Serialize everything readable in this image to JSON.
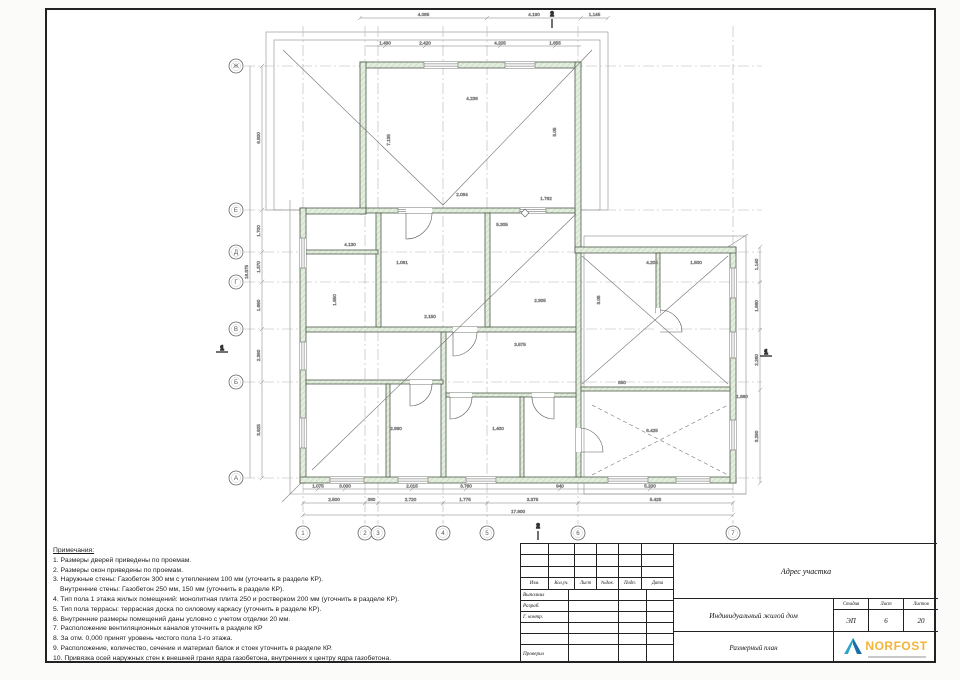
{
  "sheet": {
    "frame_color": "#222222"
  },
  "plan": {
    "colors": {
      "wall_fill": "#e3edde",
      "wall_stroke": "#4f5a4c",
      "axis": "#b3b3b3",
      "thin": "#8a8a8a",
      "diag": "#6a6a6a",
      "dim_line": "#7d7d7d",
      "dim_text": "#555555",
      "circle": "#666666"
    },
    "axes_h": [
      {
        "label": "Ж",
        "y": 66
      },
      {
        "label": "Е",
        "y": 210
      },
      {
        "label": "Д",
        "y": 252
      },
      {
        "label": "Г",
        "y": 282
      },
      {
        "label": "В",
        "y": 329
      },
      {
        "label": "Б",
        "y": 382
      },
      {
        "label": "А",
        "y": 478
      }
    ],
    "axes_v": [
      {
        "label": "1",
        "x": 303
      },
      {
        "label": "2",
        "x": 365
      },
      {
        "label": "3",
        "x": 378
      },
      {
        "label": "4",
        "x": 443
      },
      {
        "label": "5",
        "x": 487
      },
      {
        "label": "6",
        "x": 578
      },
      {
        "label": "7",
        "x": 733
      }
    ],
    "walls": [
      [
        360,
        62,
        221,
        6
      ],
      [
        360,
        62,
        6,
        152
      ],
      [
        575,
        62,
        6,
        191
      ],
      [
        300,
        208,
        66,
        6
      ],
      [
        300,
        208,
        6,
        275
      ],
      [
        300,
        477,
        436,
        6
      ],
      [
        730,
        247,
        6,
        236
      ],
      [
        575,
        247,
        161,
        6
      ],
      [
        366,
        208,
        209,
        5
      ],
      [
        306,
        327,
        272,
        5
      ],
      [
        376,
        213,
        5,
        114
      ],
      [
        441,
        332,
        5,
        145
      ],
      [
        485,
        213,
        5,
        114
      ],
      [
        576,
        253,
        5,
        224
      ],
      [
        306,
        380,
        137,
        4
      ],
      [
        446,
        393,
        130,
        4
      ],
      [
        581,
        387,
        149,
        4
      ],
      [
        656,
        253,
        4,
        60
      ],
      [
        520,
        397,
        4,
        80
      ],
      [
        386,
        384,
        4,
        93
      ],
      [
        306,
        250,
        72,
        4
      ]
    ],
    "overhangs": [
      [
        266,
        32,
        342,
        178
      ],
      [
        274,
        40,
        326,
        170
      ],
      [
        584,
        236,
        162,
        258
      ]
    ],
    "outline_lines": [
      [
        290,
        200,
        290,
        494
      ],
      [
        290,
        494,
        746,
        494
      ],
      [
        282,
        502,
        302,
        482
      ],
      [
        723,
        250,
        748,
        234
      ]
    ],
    "windows": [
      [
        424,
        62,
        34,
        6,
        "h"
      ],
      [
        505,
        62,
        30,
        6,
        "h"
      ],
      [
        300,
        238,
        6,
        30,
        "v"
      ],
      [
        300,
        342,
        6,
        28,
        "v"
      ],
      [
        300,
        418,
        6,
        30,
        "v"
      ],
      [
        330,
        477,
        34,
        6,
        "h"
      ],
      [
        398,
        477,
        30,
        6,
        "h"
      ],
      [
        466,
        477,
        30,
        6,
        "h"
      ],
      [
        608,
        477,
        40,
        6,
        "h"
      ],
      [
        676,
        477,
        34,
        6,
        "h"
      ],
      [
        730,
        268,
        6,
        30,
        "v"
      ],
      [
        730,
        332,
        6,
        26,
        "v"
      ],
      [
        730,
        420,
        6,
        30,
        "v"
      ],
      [
        398,
        208,
        26,
        5,
        "h"
      ],
      [
        520,
        208,
        26,
        5,
        "h"
      ]
    ],
    "doors": [
      {
        "gap": [
          406,
          208,
          26,
          5
        ],
        "path": "M406,213 V239 A26,26 0 0 0 432,213"
      },
      {
        "gap": [
          453,
          327,
          24,
          5
        ],
        "path": "M453,332 V356 A24,24 0 0 0 477,332"
      },
      {
        "gap": [
          656,
          308,
          4,
          24
        ],
        "path": "M660,332 H682 A22,22 0 0 0 660,310"
      },
      {
        "gap": [
          450,
          393,
          22,
          4
        ],
        "path": "M450,397 V419 A22,22 0 0 0 472,397"
      },
      {
        "gap": [
          532,
          393,
          22,
          4
        ],
        "path": "M554,397 V419 A22,22 0 0 1 532,397"
      },
      {
        "gap": [
          410,
          380,
          22,
          4
        ],
        "path": "M410,384 V406 A22,22 0 0 0 432,384"
      },
      {
        "gap": [
          576,
          428,
          5,
          24
        ],
        "path": "M581,452 H603 A24,24 0 0 0 581,428"
      }
    ],
    "diagonals": [
      {
        "l": [
          283,
          50,
          443,
          205
        ]
      },
      {
        "l": [
          592,
          50,
          443,
          205
        ]
      },
      {
        "l": [
          312,
          470,
          576,
          214
        ]
      },
      {
        "l": [
          582,
          256,
          728,
          384
        ]
      },
      {
        "l": [
          582,
          384,
          728,
          256
        ]
      },
      {
        "l": [
          592,
          405,
          728,
          475
        ],
        "dash": true
      },
      {
        "l": [
          592,
          475,
          728,
          405
        ],
        "dash": true
      }
    ],
    "dims": {
      "bottom": {
        "y": 503,
        "ticks": [
          303,
          365,
          378,
          443,
          487,
          578,
          733
        ],
        "labels": [
          "2.500",
          "380",
          "2.720",
          "1.775",
          "3.375",
          "5.425"
        ]
      },
      "bottom_total": {
        "y": 515,
        "x1": 303,
        "x2": 733,
        "label": "17.900"
      },
      "bottom2": {
        "y": 489,
        "x1": 303,
        "x2": 733,
        "labels": [
          [
            "1.075",
            318
          ],
          [
            "3.000",
            345
          ],
          [
            "2.015",
            412
          ],
          [
            "3.760",
            466
          ],
          [
            "940",
            560
          ],
          [
            "5.200",
            650
          ]
        ]
      },
      "left": {
        "x": 262,
        "ticks": [
          66,
          210,
          252,
          282,
          329,
          382,
          478
        ],
        "labels": [
          "6.800",
          "1.700",
          "1.370",
          "1.690",
          "2.360",
          "3.925"
        ]
      },
      "left_total": {
        "x": 250,
        "y1": 66,
        "y2": 478,
        "label": "16.875"
      },
      "top": {
        "y": 18,
        "ticks": [
          360,
          487,
          581,
          608
        ],
        "labels": [
          "4.085",
          "4.190",
          "1.145"
        ]
      },
      "top2": {
        "y": 46,
        "x1": 366,
        "x2": 581,
        "labels": [
          [
            "1.480",
            385
          ],
          [
            "2.420",
            425
          ],
          [
            "4.205",
            500
          ],
          [
            "1.855",
            555
          ]
        ]
      },
      "right": {
        "x": 760,
        "ticks": [
          247,
          282,
          330,
          390,
          483
        ],
        "labels": [
          "1.140",
          "1.860",
          "2.260",
          "3.290"
        ]
      },
      "misc": [
        [
          "4.236",
          472,
          100,
          0
        ],
        [
          "2.084",
          462,
          196,
          0
        ],
        [
          "1.782",
          546,
          200,
          0
        ],
        [
          "5.305",
          502,
          226,
          0
        ],
        [
          "4.130",
          350,
          246,
          0
        ],
        [
          "1.061",
          402,
          264,
          0
        ],
        [
          "2.150",
          430,
          318,
          0
        ],
        [
          "4.205",
          652,
          264,
          0
        ],
        [
          "1.500",
          696,
          264,
          0
        ],
        [
          "2.305",
          540,
          302,
          0
        ],
        [
          "3.575",
          520,
          346,
          0
        ],
        [
          "2.860",
          396,
          430,
          0
        ],
        [
          "1.400",
          498,
          430,
          0
        ],
        [
          "6.425",
          652,
          432,
          0
        ],
        [
          "850",
          622,
          384,
          0
        ],
        [
          "1.860",
          742,
          398,
          0
        ],
        [
          "7.135",
          390,
          140,
          -90
        ],
        [
          "5.05",
          556,
          132,
          -90
        ],
        [
          "1.950",
          336,
          300,
          -90
        ],
        [
          "3.08",
          600,
          300,
          -90
        ]
      ]
    },
    "markers": [
      {
        "t": "1",
        "x": 222,
        "y": 350,
        "dir": "h"
      },
      {
        "t": "1",
        "x": 766,
        "y": 354,
        "dir": "h"
      },
      {
        "t": "2",
        "x": 552,
        "y": 16,
        "dir": "v"
      },
      {
        "t": "2",
        "x": 538,
        "y": 528,
        "dir": "v"
      }
    ],
    "vent": [
      525,
      213
    ]
  },
  "notes": {
    "title": "Примечания:",
    "items": [
      "1. Размеры дверей приведены по проемам.",
      "2. Размеры окон приведены по проемам.",
      "3. Наружные стены: Газобетон 300 мм с утеплением 100 мм (уточнить в разделе КР).",
      "Внутренние стены: Газобетон 250 мм, 150 мм (уточнить в разделе КР).",
      "4. Тип пола 1 этажа жилых помещений: монолитная плита 250 и ростверком 200 мм (уточнить в разделе КР).",
      "5. Тип пола террасы: террасная доска по силовому каркасу (уточнить в разделе КР).",
      "6. Внутренние размеры помещений даны условно с учетом отделки 20 мм.",
      "7. Расположение вентиляционных каналов уточнить в разделе КР",
      "8. За отм. 0,000 принят уровень чистого пола 1-го этажа.",
      "9. Расположение, количество, сечение и материал балок и стоек уточнить в разделе КР.",
      "10. Привязка осей наружных стен к внешней грани ядра газобетона, внутренних к центру ядра газобетона."
    ]
  },
  "stamp": {
    "header_cells": [
      "Изм.",
      "Кол.уч.",
      "Лист",
      "№док.",
      "Подп.",
      "Дата"
    ],
    "rows": [
      "Выполнил",
      "Разраб.",
      "Г. контр.",
      "",
      "",
      "Проверил"
    ],
    "object_address": "Адрес участка",
    "project_name": "Индивидуальный жилой дом",
    "drawing_title": "Размерный план",
    "stage_label": "Стадия",
    "stage_value": "ЭП",
    "sheet_label": "Лист",
    "sheet_value": "6",
    "sheets_label": "Листов",
    "sheets_value": "20",
    "logo_text": "NORFOST",
    "logo_colors": {
      "triangle": "#2ba6c9",
      "triangle_dark": "#1c6fa6",
      "text": "#f0b53a"
    }
  }
}
